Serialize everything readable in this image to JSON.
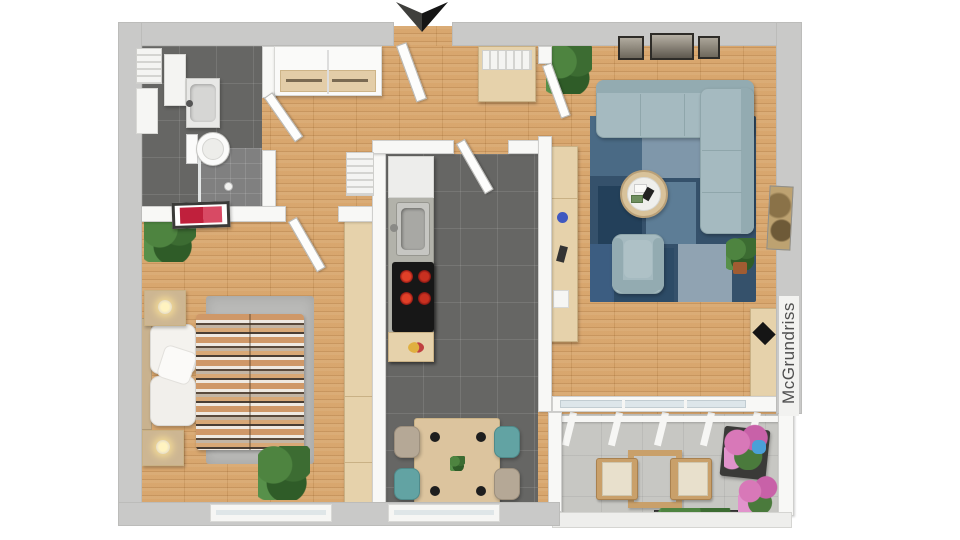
{
  "watermark": {
    "label": "McGrundriss"
  },
  "palette": {
    "background": "#ffffff",
    "exterior_wall": "#c9c9c8",
    "interior_wall": "#f8f8f6",
    "wood_floor": "#d7a368",
    "dark_tile_floor": "#666664",
    "balcony_tile_floor": "#c7c7c3",
    "sofa_armchair": "#a5bac0",
    "rug_blue": "#35516b",
    "rug_gray": "#b9b9b7",
    "cabinet_wood": "#e6d2ab",
    "duvet_stripe_orange": "#cf9868",
    "duvet_stripe_dark": "#4a3e34",
    "dining_chair_teal": "#62a3a3",
    "dining_chair_beige": "#b5a896",
    "stove_burner_red": "#d03020",
    "wall_art_red": "#c0203c",
    "plant_green": "#4a7d3a",
    "entrance_arrow": "#1c1c1c"
  },
  "rooms": [
    {
      "name": "bathroom",
      "floor": "dark-tile"
    },
    {
      "name": "hallway",
      "floor": "wood"
    },
    {
      "name": "bedroom",
      "floor": "wood"
    },
    {
      "name": "kitchen",
      "floor": "dark-tile"
    },
    {
      "name": "living-room",
      "floor": "wood"
    },
    {
      "name": "balcony",
      "floor": "stone-tile"
    }
  ],
  "furniture": {
    "bathroom": [
      "radiator",
      "mirror",
      "vanity-sink",
      "toilet",
      "shower"
    ],
    "hallway": [
      "entrance-arrow",
      "entrance-door",
      "white-closet",
      "shoe-cabinet-with-radiator",
      "radiator"
    ],
    "bedroom": [
      "double-bed-striped-duvet",
      "pillows",
      "nightstand-with-lamp-x2",
      "gray-rug",
      "wardrobe",
      "plant",
      "red-wall-art",
      "plant-on-stool",
      "window"
    ],
    "kitchen": [
      "counter",
      "sink",
      "stove",
      "fruit-bowl",
      "dining-table",
      "four-chairs",
      "window"
    ],
    "living_room": [
      "corner-sofa",
      "armchair",
      "round-coffee-table",
      "blue-patchwork-rug",
      "sideboard",
      "desk-with-laptop",
      "three-wall-pictures",
      "wall-art",
      "plants"
    ],
    "balcony": [
      "pergola-glass-roof",
      "two-wood-chairs",
      "side-table",
      "plant-stand",
      "flowers",
      "planter-box"
    ]
  }
}
